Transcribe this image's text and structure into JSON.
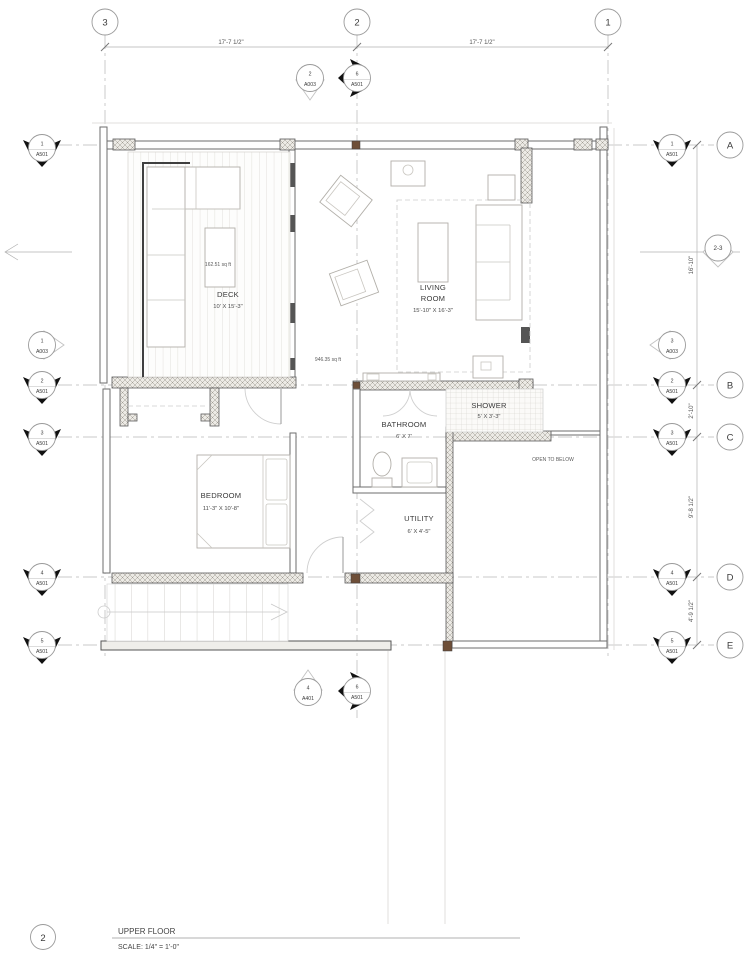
{
  "grid": {
    "cols": [
      "3",
      "2",
      "1"
    ],
    "rows": [
      "A",
      "B",
      "C",
      "D",
      "E"
    ]
  },
  "dims": {
    "top": [
      "17'-7 1/2\"",
      "17'-7 1/2\""
    ],
    "right": [
      "16'-10\"",
      "2'-10\"",
      "9'-8 1/2\"",
      "4'-9 1/2\""
    ]
  },
  "markers": {
    "left": [
      {
        "num": "1",
        "sheet": "A501"
      },
      {
        "num": "1",
        "sheet": "A003"
      },
      {
        "num": "2",
        "sheet": "A501"
      },
      {
        "num": "3",
        "sheet": "A501"
      },
      {
        "num": "4",
        "sheet": "A501"
      },
      {
        "num": "5",
        "sheet": "A501"
      }
    ],
    "right": [
      {
        "num": "1",
        "sheet": "A501"
      },
      {
        "num": "3",
        "sheet": "A003"
      },
      {
        "num": "2",
        "sheet": "A501"
      },
      {
        "num": "3",
        "sheet": "A501"
      },
      {
        "num": "4",
        "sheet": "A501"
      },
      {
        "num": "5",
        "sheet": "A501"
      }
    ],
    "top": [
      {
        "num": "2",
        "sheet": "A003"
      },
      {
        "num": "6",
        "sheet": "A501"
      }
    ],
    "bottom": [
      {
        "num": "4",
        "sheet": "A401"
      },
      {
        "num": "6",
        "sheet": "A501"
      }
    ],
    "level": "2-3"
  },
  "rooms": {
    "deck": {
      "name": "DECK",
      "size": "10' X 15'-3\"",
      "area": "162.51 sq ft"
    },
    "living": {
      "name_line1": "LIVING",
      "name_line2": "ROOM",
      "size": "15'-10\" X 16'-3\"",
      "area": "946.35 sq ft"
    },
    "bathroom": {
      "name": "BATHROOM",
      "size": "6' X 7'"
    },
    "shower": {
      "name": "SHOWER",
      "size": "5' X 3'-3\""
    },
    "bedroom": {
      "name": "BEDROOM",
      "size": "11'-3\" X 10'-8\""
    },
    "utility": {
      "name": "UTILITY",
      "size": "6' X 4'-5\""
    }
  },
  "annotations": {
    "open_to_below": "OPEN TO BELOW"
  },
  "title_block": {
    "number": "2",
    "title": "UPPER FLOOR",
    "scale": "SCALE: 1/4\" = 1'-0\""
  },
  "colors": {
    "wall": "#5a5a5a",
    "wood_post": "#6e4f38",
    "hatch_bg": "#eceae5"
  }
}
